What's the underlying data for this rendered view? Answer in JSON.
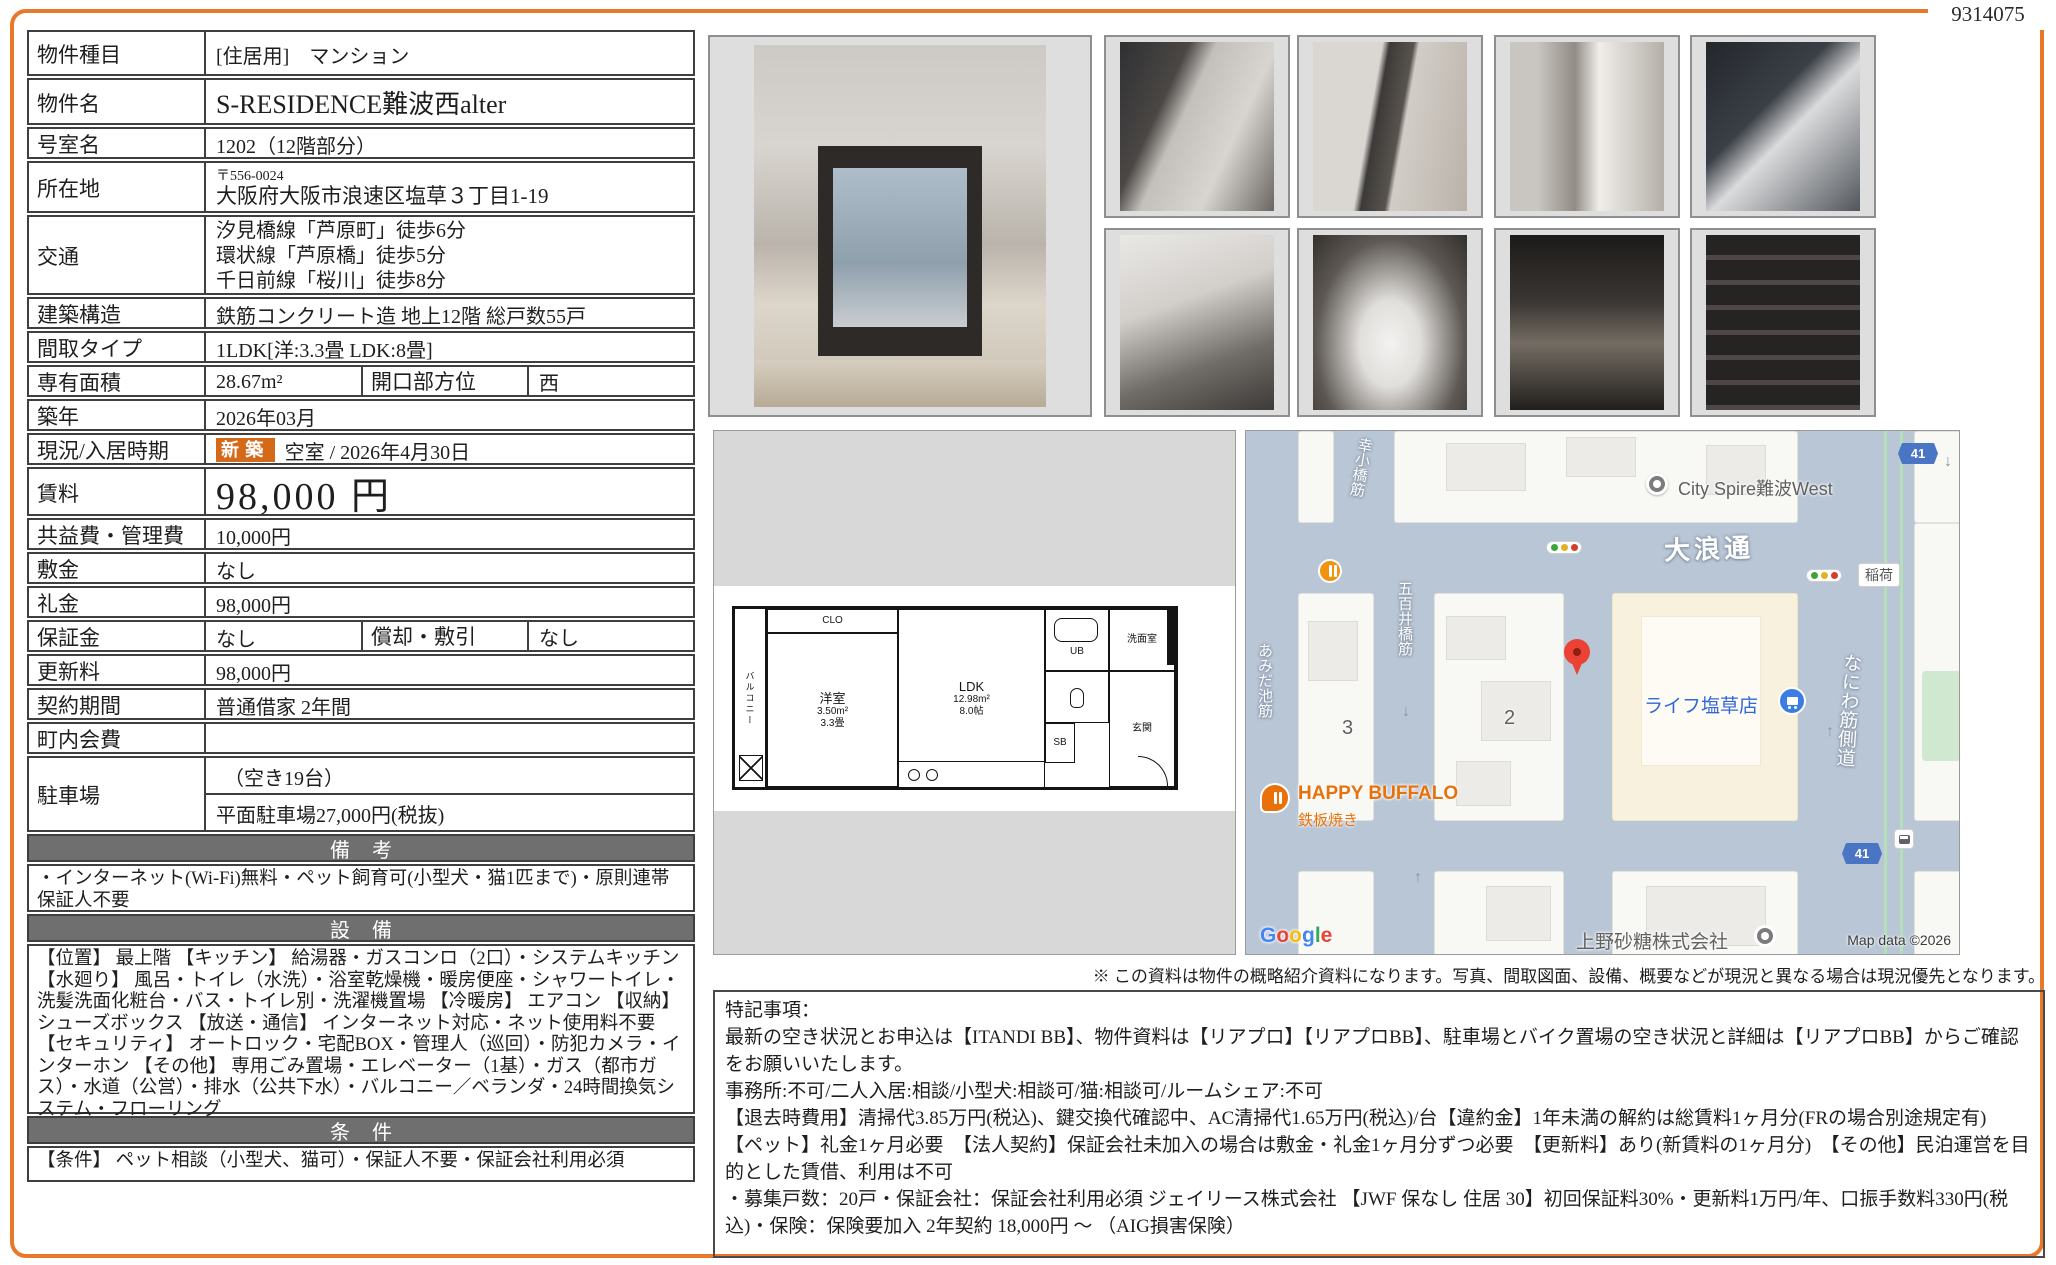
{
  "doc_number": "9314075",
  "table": {
    "property_type": {
      "label": "物件種目",
      "value": "[住居用]　マンション"
    },
    "property_name": {
      "label": "物件名",
      "value": "S-RESIDENCE難波西alter"
    },
    "room_no": {
      "label": "号室名",
      "value": "1202（12階部分）"
    },
    "address": {
      "label": "所在地",
      "postal": "〒556-0024",
      "value": "大阪府大阪市浪速区塩草３丁目1-19"
    },
    "access": {
      "label": "交通",
      "line1": "汐見橋線「芦原町」徒歩6分",
      "line2": "環状線「芦原橋」徒歩5分",
      "line3": "千日前線「桜川」徒歩8分"
    },
    "structure": {
      "label": "建築構造",
      "value": "鉄筋コンクリート造 地上12階 総戸数55戸"
    },
    "layout_type": {
      "label": "間取タイプ",
      "value": "1LDK[洋:3.3畳 LDK:8畳]"
    },
    "area": {
      "label": "専有面積",
      "value": "28.67m²",
      "label2": "開口部方位",
      "value2": "西"
    },
    "built": {
      "label": "築年",
      "value": "2026年03月"
    },
    "status": {
      "label": "現況/入居時期",
      "badge": "新築",
      "value": "空室 / 2026年4月30日"
    },
    "rent": {
      "label": "賃料",
      "value": "98,000 円"
    },
    "fees": {
      "label": "共益費・管理費",
      "value": "10,000円"
    },
    "deposit": {
      "label": "敷金",
      "value": "なし"
    },
    "key_money": {
      "label": "礼金",
      "value": "98,000円"
    },
    "guarantee": {
      "label": "保証金",
      "value": "なし",
      "label2": "償却・敷引",
      "value2": "なし"
    },
    "renewal": {
      "label": "更新料",
      "value": "98,000円"
    },
    "contract": {
      "label": "契約期間",
      "value": "普通借家 2年間"
    },
    "town_fee": {
      "label": "町内会費",
      "value": ""
    },
    "parking": {
      "label": "駐車場",
      "availability": "（空き19台）",
      "price": "平面駐車場27,000円(税抜)"
    },
    "remarks": {
      "header": "備考",
      "text": "・インターネット(Wi-Fi)無料・ペット飼育可(小型犬・猫1匹まで)・原則連帯保証人不要"
    },
    "equipment": {
      "header": "設備",
      "text": "【位置】 最上階 【キッチン】 給湯器・ガスコンロ（2口）・システムキッチン 【水廻り】 風呂・トイレ（水洗）・浴室乾燥機・暖房便座・シャワートイレ・洗髪洗面化粧台・バス・トイレ別・洗濯機置場 【冷暖房】 エアコン 【収納】 シューズボックス 【放送・通信】 インターネット対応・ネット使用料不要 【セキュリティ】 オートロック・宅配BOX・管理人（巡回）・防犯カメラ・インターホン 【その他】 専用ごみ置場・エレベーター（1基）・ガス（都市ガス）・水道（公営）・排水（公共下水）・バルコニー／ベランダ・24時間換気システム・フローリング"
    },
    "conditions": {
      "header": "条件",
      "text": "【条件】 ペット相談（小型犬、猫可）・保証人不要・保証会社利用必須"
    }
  },
  "floorplan": {
    "balcony": "バルコニー",
    "clo": "CLO",
    "western_room": "洋室",
    "western_room_area": "3.50m²",
    "western_room_tatami": "3.3畳",
    "ldk": "LDK",
    "ldk_area": "12.98m²",
    "ldk_tatami": "8.0帖",
    "ub": "UB",
    "washroom": "洗面室",
    "entrance": "玄関",
    "sb": "SB"
  },
  "map": {
    "streets": {
      "onami_dori": "大浪通",
      "naniwa_suji": "なにわ筋側道",
      "saikobashi_suji": "幸小橋筋",
      "ioibashi_suji": "五百井橋筋",
      "amidaike_suji": "あみだ池筋"
    },
    "route_shield": "41",
    "pois": {
      "city_spire": "City Spire難波West",
      "life_store": "ライフ塩草店",
      "happy_buffalo": "HAPPY BUFFALO",
      "teppanyaki": "鉄板焼き",
      "ueno_sugar": "上野砂糖株式会社",
      "inari": "稲荷"
    },
    "block_3": "3",
    "block_2": "2",
    "google": "Google",
    "copyright": "Map data ©2026"
  },
  "disclaimer": "※ この資料は物件の概略紹介資料になります。写真、間取図面、設備、概要などが現況と異なる場合は現況優先となります。",
  "notes": {
    "title": "特記事項：",
    "p1": "最新の空き状況とお申込は【ITANDI BB】、物件資料は【リアプロ】【リアプロBB】、駐車場とバイク置場の空き状況と詳細は【リアプロBB】からご確認をお願いいたします。",
    "p2": "事務所:不可/二人入居:相談/小型犬:相談可/猫:相談可/ルームシェア:不可",
    "p3": "【退去時費用】清掃代3.85万円(税込)、鍵交換代確認中、AC清掃代1.65万円(税込)/台【違約金】1年未満の解約は総賃料1ヶ月分(FRの場合別途規定有)　【ペット】礼金1ヶ月必要　【法人契約】保証会社未加入の場合は敷金・礼金1ヶ月分ずつ必要　【更新料】あり(新賃料の1ヶ月分)　【その他】民泊運営を目的とした賃借、利用は不可",
    "p4": "・募集戸数：20戸・保証会社：保証会社利用必須 ジェイリース株式会社 【JWF 保なし 住居 30】初回保証料30%・更新料1万円/年、口振手数料330円(税込)・保険：保険要加入 2年契約 18,000円 〜 （AIG損害保険）"
  }
}
